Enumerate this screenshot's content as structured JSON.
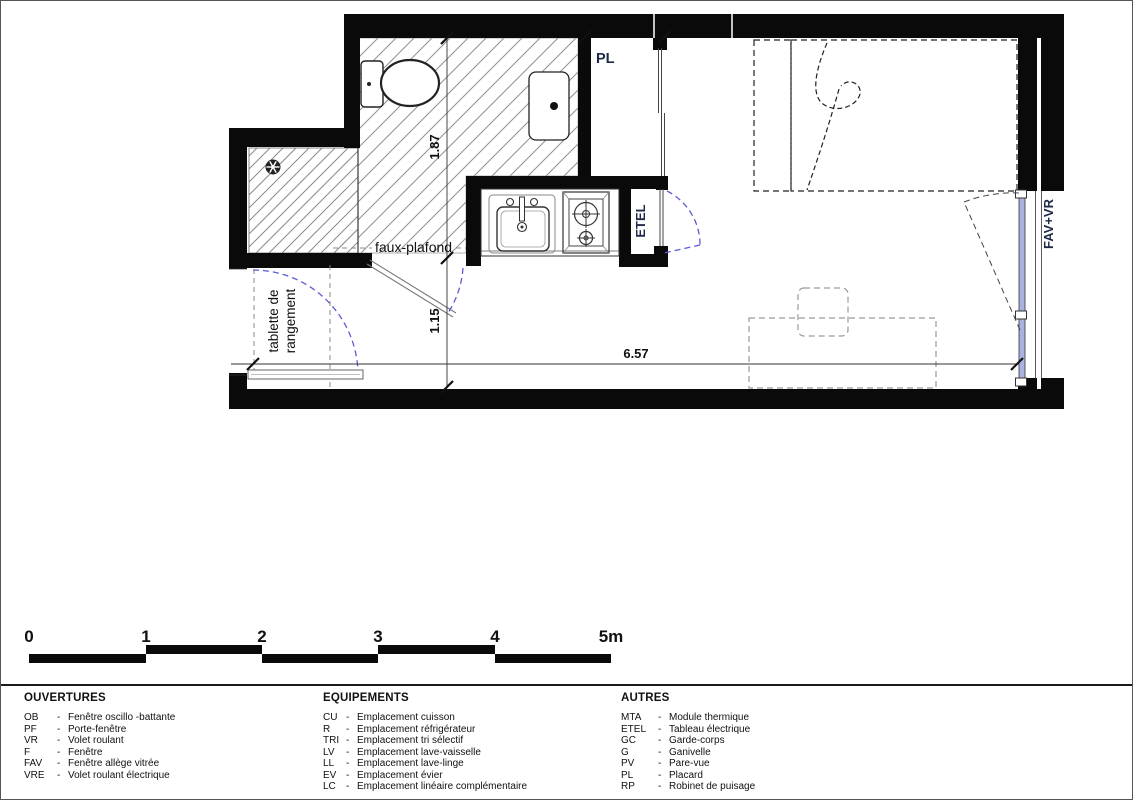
{
  "plan": {
    "room_labels": {
      "placard": "PL",
      "tableau_electrique": "ETEL",
      "window_right": "FAV+VR"
    },
    "annotations": {
      "faux_plafond": "faux-plafond",
      "tablette_line1": "tablette de",
      "tablette_line2": "rangement"
    },
    "dimensions": {
      "bathroom_depth": "1.87",
      "entry_depth": "1.15",
      "room_width": "6.57"
    }
  },
  "scale_bar": {
    "labels": [
      "0",
      "1",
      "2",
      "3",
      "4",
      "5m"
    ]
  },
  "legend": {
    "separator": "-",
    "columns": [
      {
        "title": "OUVERTURES",
        "items": [
          {
            "abbr": "OB",
            "label": "Fenêtre oscillo -battante"
          },
          {
            "abbr": "PF",
            "label": "Porte-fenêtre"
          },
          {
            "abbr": "VR",
            "label": "Volet roulant"
          },
          {
            "abbr": "F",
            "label": "Fenêtre"
          },
          {
            "abbr": "FAV",
            "label": "Fenêtre allège vitrée"
          },
          {
            "abbr": "VRE",
            "label": "Volet roulant électrique"
          }
        ]
      },
      {
        "title": "EQUIPEMENTS",
        "items": [
          {
            "abbr": "CU",
            "label": "Emplacement cuisson"
          },
          {
            "abbr": "R",
            "label": "Emplacement réfrigérateur"
          },
          {
            "abbr": "TRI",
            "label": "Emplacement tri sélectif"
          },
          {
            "abbr": "LV",
            "label": "Emplacement lave-vaisselle"
          },
          {
            "abbr": "LL",
            "label": "Emplacement lave-linge"
          },
          {
            "abbr": "EV",
            "label": "Emplacement évier"
          },
          {
            "abbr": "LC",
            "label": "Emplacement linéaire complémentaire"
          }
        ]
      },
      {
        "title": "AUTRES",
        "items": [
          {
            "abbr": "MTA",
            "label": "Module thermique"
          },
          {
            "abbr": "ETEL",
            "label": "Tableau électrique"
          },
          {
            "abbr": "GC",
            "label": "Garde-corps"
          },
          {
            "abbr": "G",
            "label": "Ganivelle"
          },
          {
            "abbr": "PV",
            "label": "Pare-vue"
          },
          {
            "abbr": "PL",
            "label": "Placard"
          },
          {
            "abbr": "RP",
            "label": "Robinet de puisage"
          }
        ]
      }
    ]
  },
  "colors": {
    "door_swing": "#5b5bd6",
    "window_glazing": "#aab3e0",
    "label_navy": "#1e2a45",
    "hatch": "#909090",
    "wall": "#0a0a0a"
  }
}
